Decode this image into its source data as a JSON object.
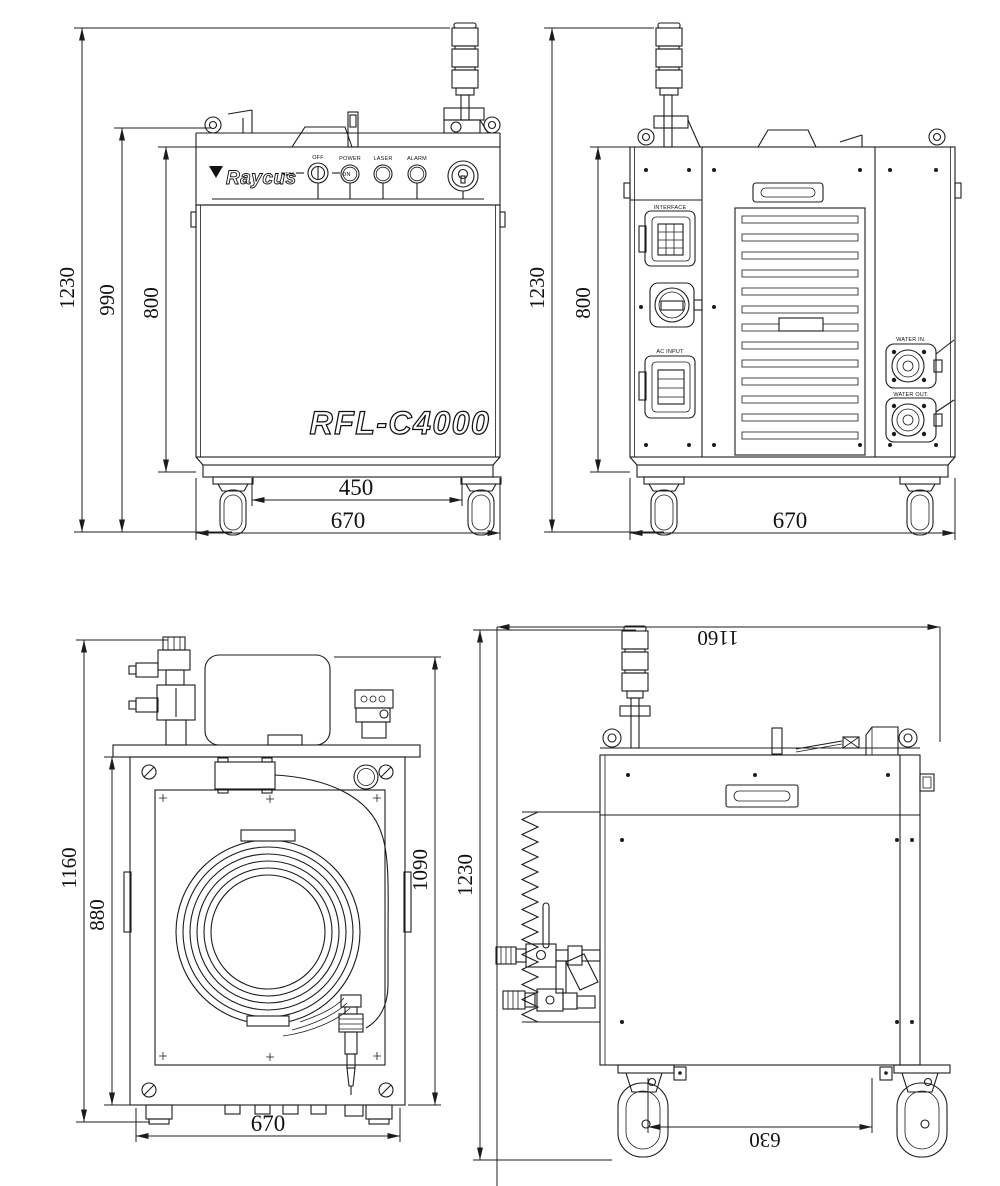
{
  "drawing": {
    "brand": "Raycus",
    "model": "RFL-C4000",
    "front_panel": {
      "switch": {
        "top": "OFF",
        "left": "REM",
        "right": "ON"
      },
      "indicators": {
        "power": "POWER",
        "laser": "LASER",
        "alarm": "ALARM"
      }
    },
    "rear_panel": {
      "interface_label": "INTERFACE",
      "ac_input_label": "AC INPUT",
      "water_in_label": "WATER IN.",
      "water_out_label": "WATER OUT."
    },
    "dimensions": {
      "front": {
        "total_height": "1230",
        "frame_height": "990",
        "body_height": "800",
        "caster_span": "450",
        "width": "670"
      },
      "back": {
        "total_height": "1230",
        "body_height": "800",
        "width": "670"
      },
      "top": {
        "total_length": "1160",
        "body_length": "880",
        "inner_length": "1090",
        "width": "670"
      },
      "side": {
        "total_length": "1160",
        "total_height": "1230",
        "caster_span": "630"
      }
    }
  }
}
